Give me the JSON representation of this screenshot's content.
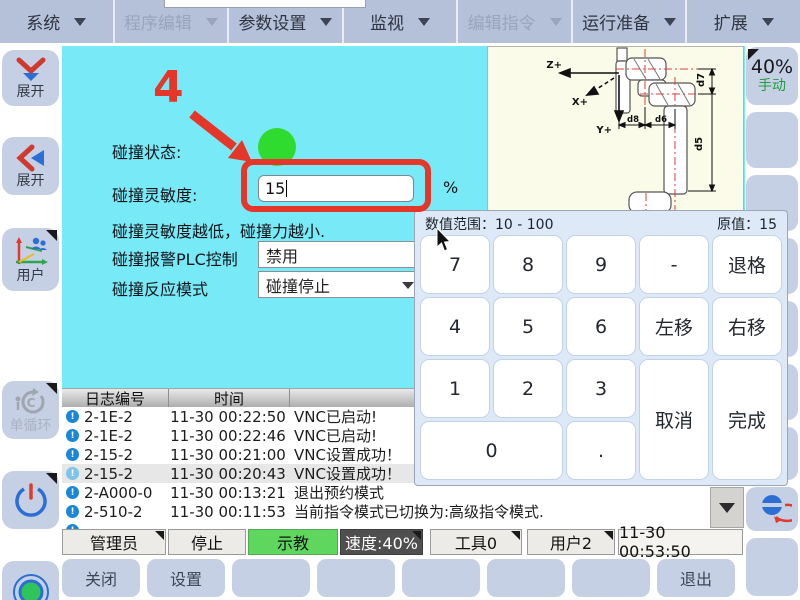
{
  "menu": {
    "items": [
      {
        "label": "系统",
        "enabled": true
      },
      {
        "label": "程序编辑",
        "enabled": false
      },
      {
        "label": "参数设置",
        "enabled": true
      },
      {
        "label": "监视",
        "enabled": true
      },
      {
        "label": "编辑指令",
        "enabled": false
      },
      {
        "label": "运行准备",
        "enabled": true
      },
      {
        "label": "扩展",
        "enabled": true
      }
    ]
  },
  "sidebar": {
    "expand_down_label": "展开",
    "expand_left_label": "展开",
    "user_label": "用户",
    "single_cycle_label": "单循环"
  },
  "collision": {
    "status_label": "碰撞状态:",
    "sensitivity_label": "碰撞灵敏度:",
    "sensitivity_value": "15",
    "sensitivity_unit": "%",
    "hint": "碰撞灵敏度越低，碰撞力越小.",
    "plc_label": "碰撞报警PLC控制",
    "plc_value": "禁用",
    "mode_label": "碰撞反应模式",
    "mode_value": "碰撞停止"
  },
  "annotation": {
    "step": "4"
  },
  "keypad": {
    "range_label": "数值范围：10 - 100",
    "original_label": "原值：15",
    "keys": {
      "k7": "7",
      "k8": "8",
      "k9": "9",
      "minus": "-",
      "backspace": "退格",
      "k4": "4",
      "k5": "5",
      "k6": "6",
      "move_left": "左移",
      "move_right": "右移",
      "k1": "1",
      "k2": "2",
      "k3": "3",
      "k0": "0",
      "dot": ".",
      "cancel": "取消",
      "done": "完成"
    }
  },
  "log": {
    "headers": [
      "日志编号",
      "时间",
      ""
    ],
    "rows": [
      {
        "id": "2-1E-2",
        "time": "11-30 00:22:50",
        "msg": "VNC已启动!"
      },
      {
        "id": "2-1E-2",
        "time": "11-30 00:22:46",
        "msg": "VNC已启动!"
      },
      {
        "id": "2-15-2",
        "time": "11-30 00:21:00",
        "msg": "VNC设置成功！"
      },
      {
        "id": "2-15-2",
        "time": "11-30 00:20:43",
        "msg": "VNC设置成功！"
      },
      {
        "id": "2-A000-0",
        "time": "11-30 00:13:21",
        "msg": "退出预约模式"
      },
      {
        "id": "2-510-2",
        "time": "11-30 00:11:53",
        "msg": "当前指令模式已切换为:高级指令模式."
      },
      {
        "id": "",
        "time": "",
        "msg": ""
      }
    ]
  },
  "status_bar": {
    "user": "管理员",
    "run_state": "停止",
    "mode": "示教",
    "speed": "速度:40%",
    "tool": "工具0",
    "user_frame": "用户2",
    "time": "11-30 00:53:50"
  },
  "bottom_bar": {
    "close": "关闭",
    "settings": "设置",
    "exit": "退出"
  },
  "right_panel": {
    "speed": "40%",
    "mode": "手动"
  },
  "diagram": {
    "labels": {
      "z": "Z+",
      "x": "X+",
      "y": "Y+",
      "d8": "d8",
      "d6": "d6",
      "d7": "d7",
      "d5": "d5"
    }
  },
  "colors": {
    "accent_red": "#e5362a",
    "cyan_bg": "#78e9f6",
    "teach_green": "#5fd75f",
    "status_dot_green": "#2edb2e",
    "button_blue": "#c6d0e4",
    "info_blue": "#1b86d8"
  }
}
